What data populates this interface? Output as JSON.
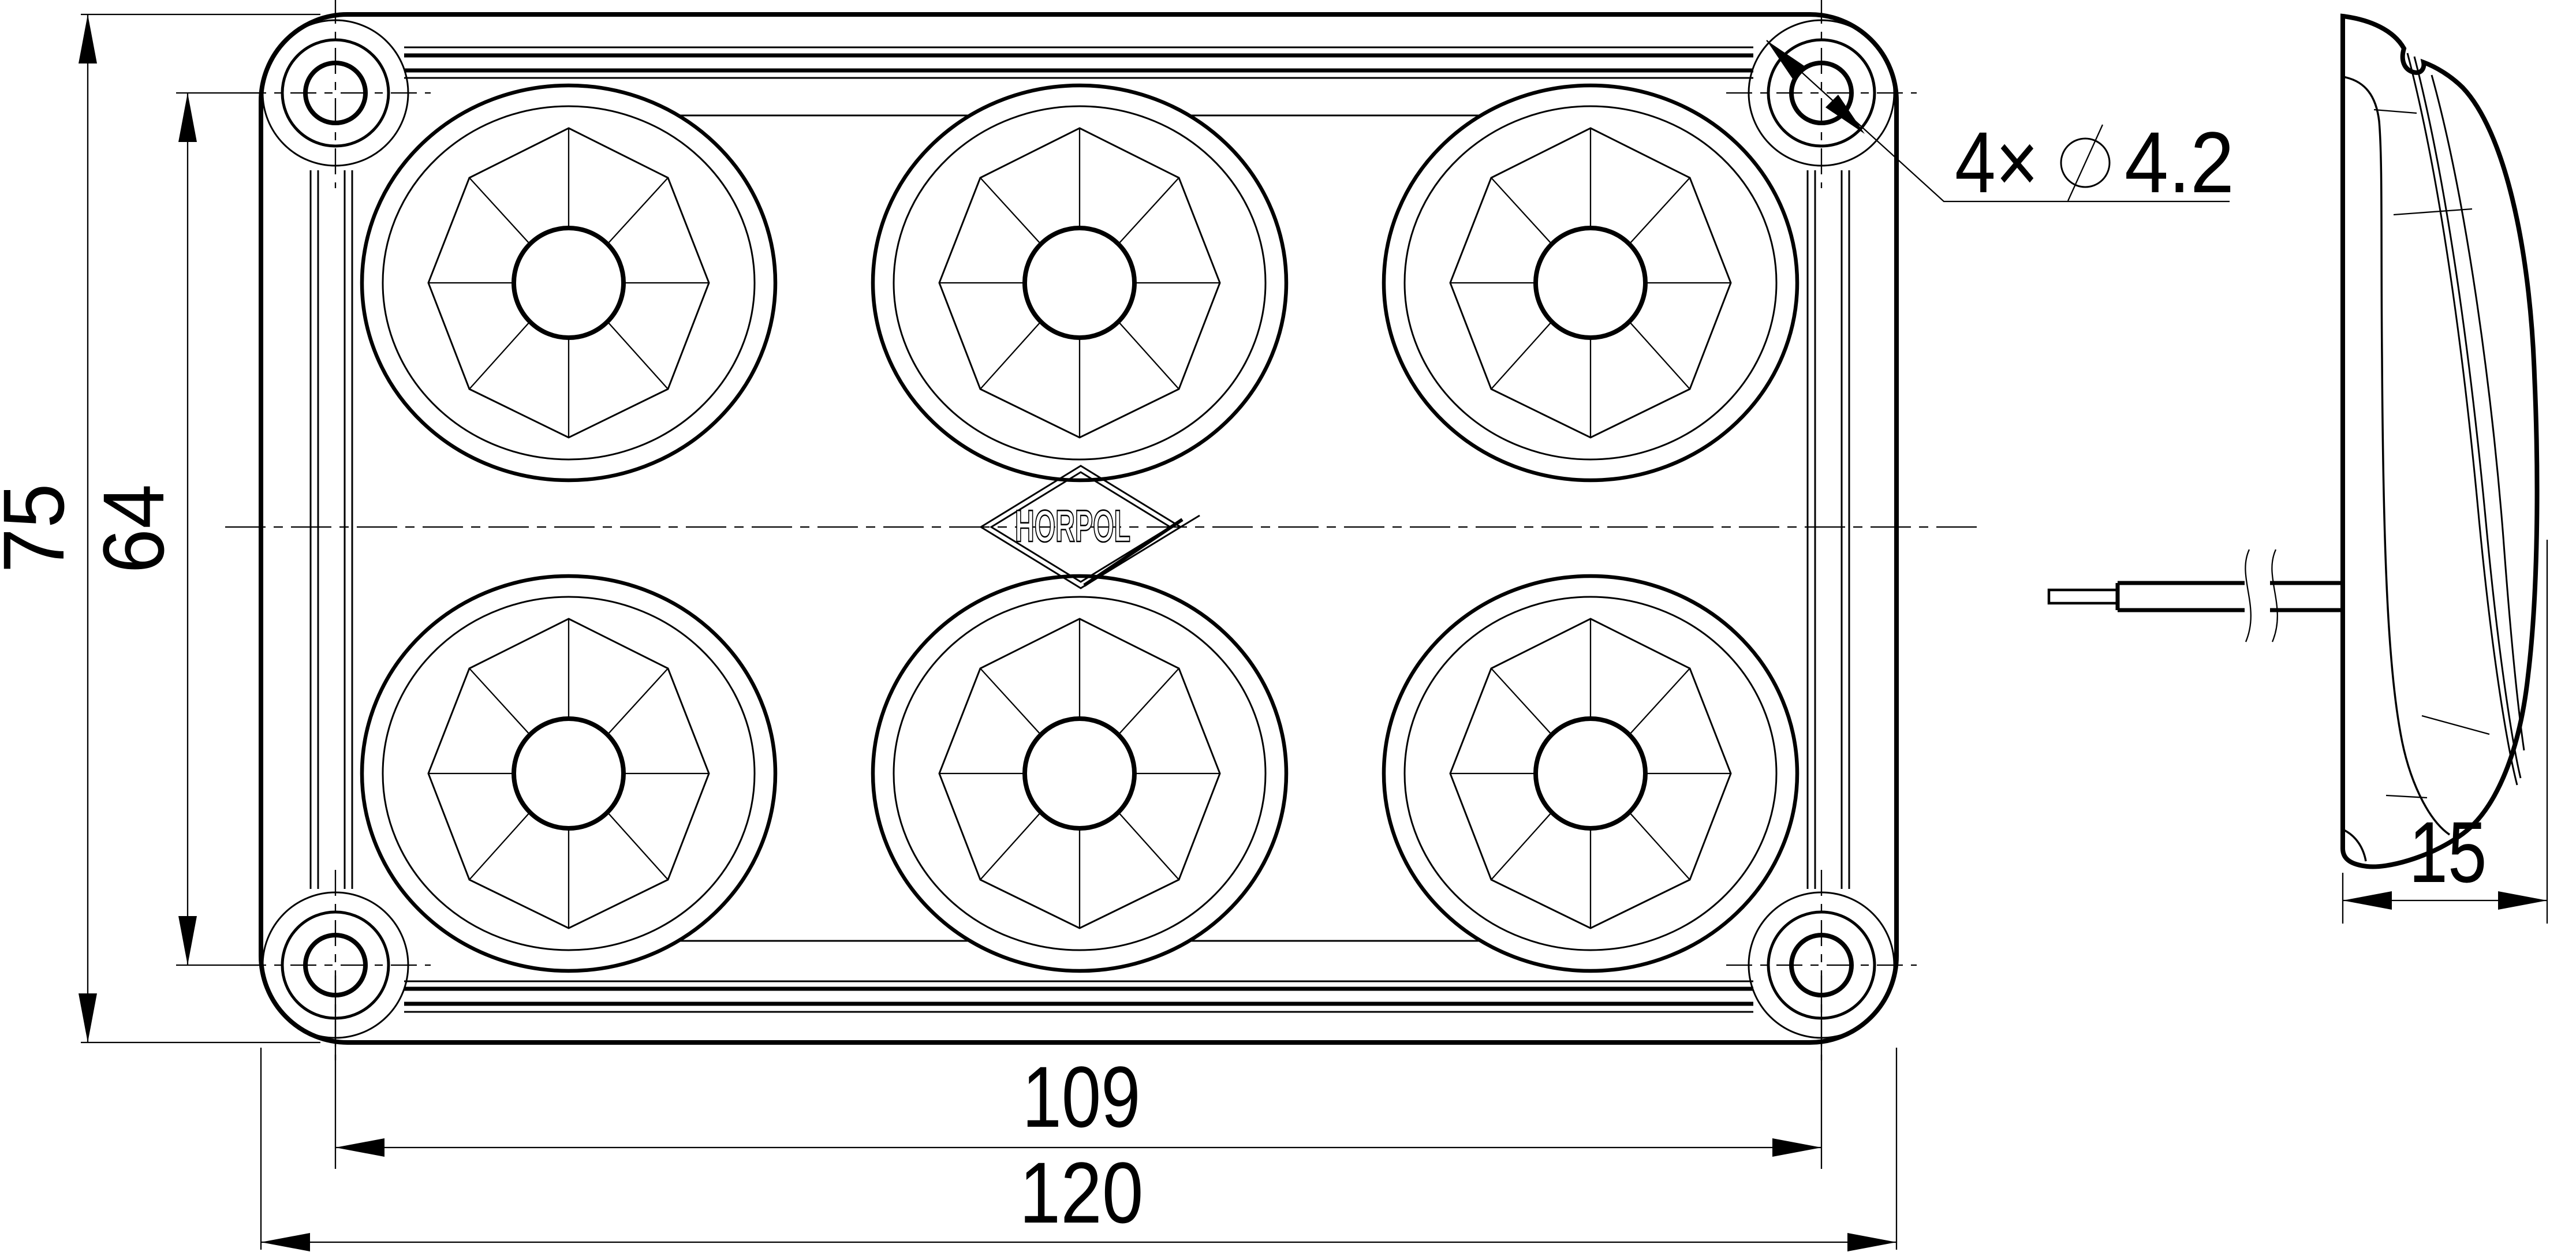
{
  "canvas": {
    "background": "#ffffff",
    "ink": "#000000"
  },
  "views": {
    "front": {
      "logo": "HORPOL"
    },
    "side": {}
  },
  "dimensions": {
    "overall_height": "75",
    "mounting_hole_spacing_vertical": "64",
    "mounting_hole_spacing_horizontal": "109",
    "overall_width": "120",
    "depth": "15",
    "mounting_hole_note": {
      "count": "4×",
      "diameter_value": "4.2",
      "symbol_icon": "slashed-circle-diameter"
    }
  }
}
